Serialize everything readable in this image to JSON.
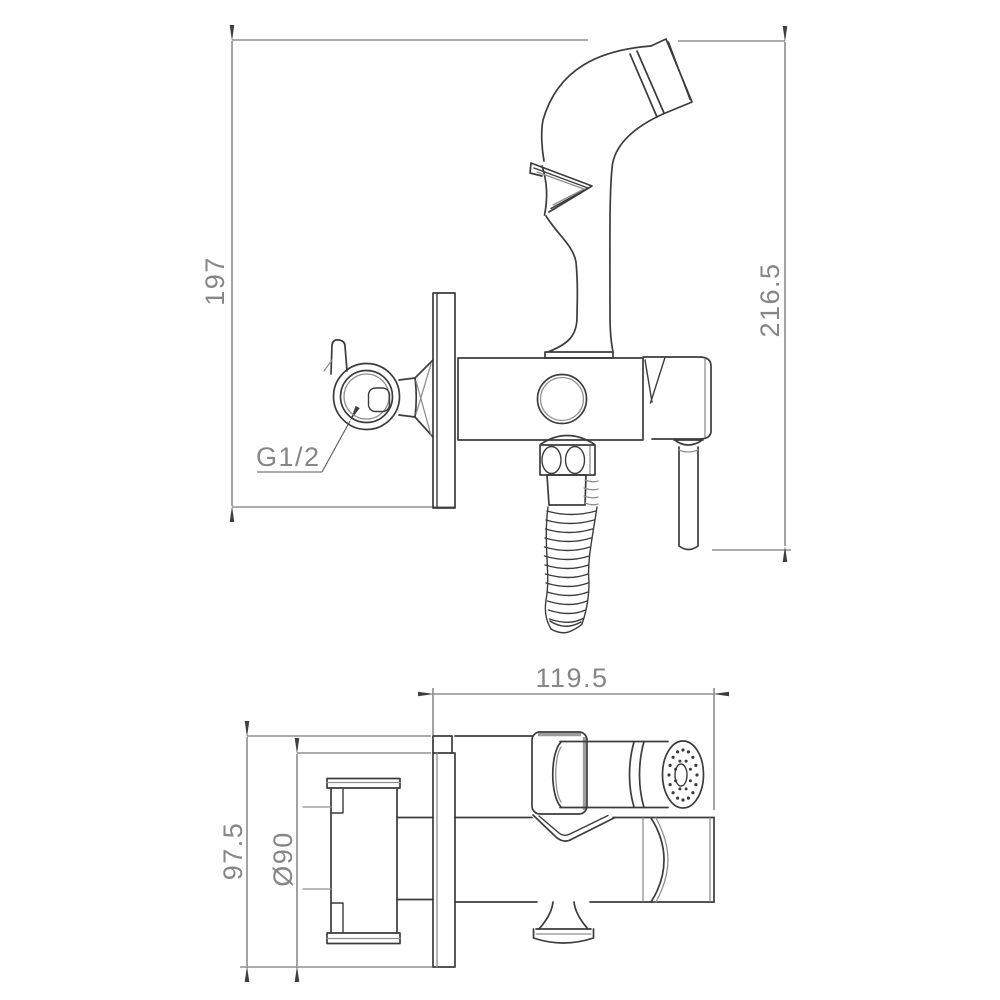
{
  "drawing_type": "technical-orthographic-drawing",
  "subject": "wall-mounted hygienic bidet sprayer set with shut-off valve",
  "colors": {
    "background": "#ffffff",
    "geometry_line": "#3c3c3c",
    "secondary_line": "#8f8f8f",
    "dimension_line": "#58585c",
    "dimension_text": "#868686"
  },
  "dims": {
    "front_height_left": "197",
    "front_height_right": "216.5",
    "thread_label": "G1/2",
    "top_width": "119.5",
    "top_depth": "97.5",
    "plate_diameter": "Ø90"
  }
}
